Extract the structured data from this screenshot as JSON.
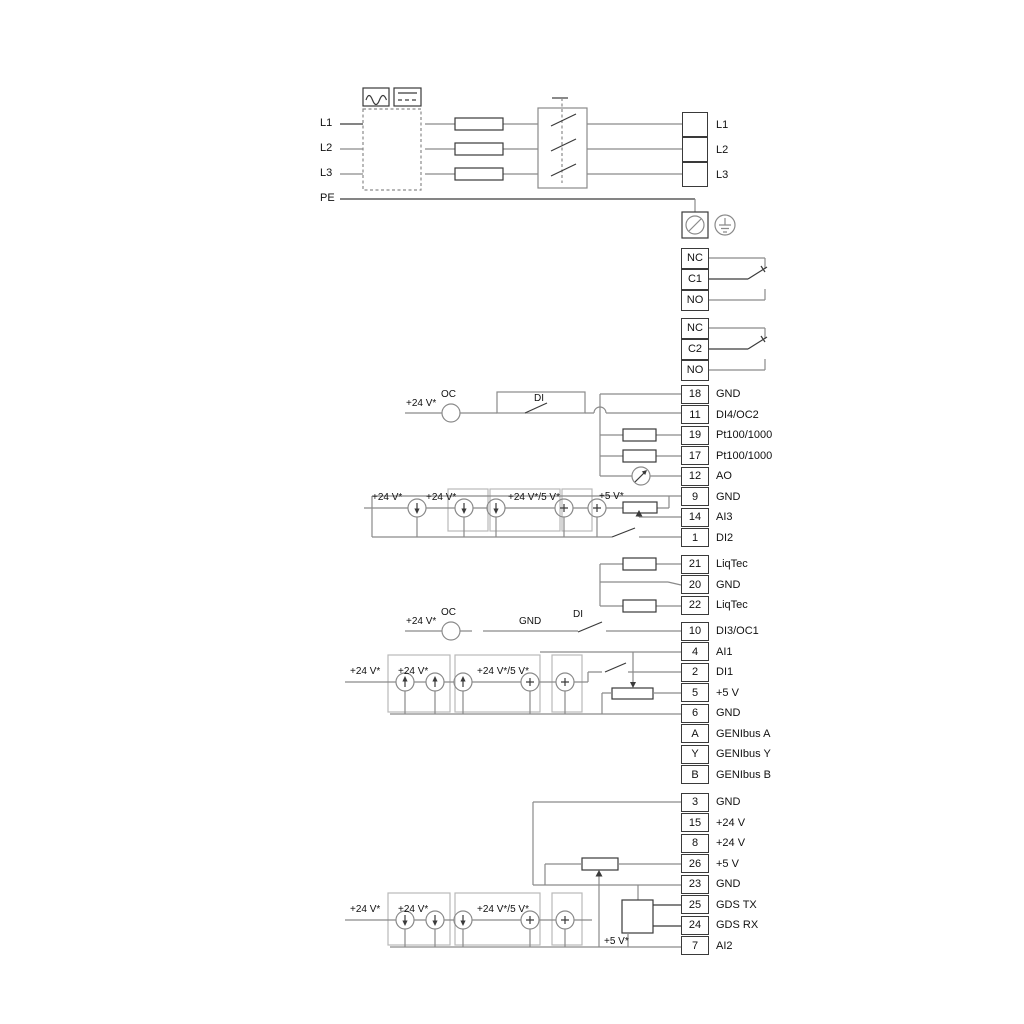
{
  "power": {
    "inputs": [
      "L1",
      "L2",
      "L3"
    ],
    "pe_label": "PE",
    "outputs": [
      "L1",
      "L2",
      "L3"
    ]
  },
  "relays": [
    {
      "rows": [
        "NC",
        "C1",
        "NO"
      ]
    },
    {
      "rows": [
        "NC",
        "C2",
        "NO"
      ]
    }
  ],
  "groups": {
    "io1": [
      {
        "num": "18",
        "label": "GND"
      },
      {
        "num": "11",
        "label": "DI4/OC2"
      },
      {
        "num": "19",
        "label": "Pt100/1000"
      },
      {
        "num": "17",
        "label": "Pt100/1000"
      },
      {
        "num": "12",
        "label": "AO"
      },
      {
        "num": "9",
        "label": "GND"
      },
      {
        "num": "14",
        "label": "AI3"
      },
      {
        "num": "1",
        "label": "DI2"
      }
    ],
    "liqtec": [
      {
        "num": "21",
        "label": "LiqTec"
      },
      {
        "num": "20",
        "label": "GND"
      },
      {
        "num": "22",
        "label": "LiqTec"
      }
    ],
    "io2": [
      {
        "num": "10",
        "label": "DI3/OC1"
      },
      {
        "num": "4",
        "label": "AI1"
      },
      {
        "num": "2",
        "label": "DI1"
      },
      {
        "num": "5",
        "label": "+5 V"
      },
      {
        "num": "6",
        "label": "GND"
      },
      {
        "num": "A",
        "label": "GENIbus A"
      },
      {
        "num": "Y",
        "label": "GENIbus Y"
      },
      {
        "num": "B",
        "label": "GENIbus B"
      }
    ],
    "io3": [
      {
        "num": "3",
        "label": "GND"
      },
      {
        "num": "15",
        "label": "+24 V"
      },
      {
        "num": "8",
        "label": "+24 V"
      },
      {
        "num": "26",
        "label": "+5 V"
      },
      {
        "num": "23",
        "label": "GND"
      },
      {
        "num": "25",
        "label": "GDS TX"
      },
      {
        "num": "24",
        "label": "GDS RX"
      },
      {
        "num": "7",
        "label": "AI2"
      }
    ]
  },
  "annotations": {
    "oc2_supply": "+24 V*",
    "oc2_oc": "OC",
    "oc2_di": "DI",
    "ai3": {
      "l1": "+24 V*",
      "l2": "+24 V*",
      "l3": "+24 V*/5 V*",
      "l4": "+5 V*"
    },
    "oc1_supply": "+24 V*",
    "oc1_oc": "OC",
    "oc1_gnd": "GND",
    "oc1_di": "DI",
    "ai1": {
      "l1": "+24 V*",
      "l2": "+24 V*",
      "l3": "+24 V*/5 V*"
    },
    "ai2": {
      "l1": "+24 V*",
      "l2": "+24 V*",
      "l3": "+24 V*/5 V*",
      "l4": "+5 V*"
    }
  },
  "colors": {
    "wire": "#8a8a8a",
    "dark": "#3a3a3a",
    "frame": "#b9b9b9",
    "text": "#111111"
  }
}
